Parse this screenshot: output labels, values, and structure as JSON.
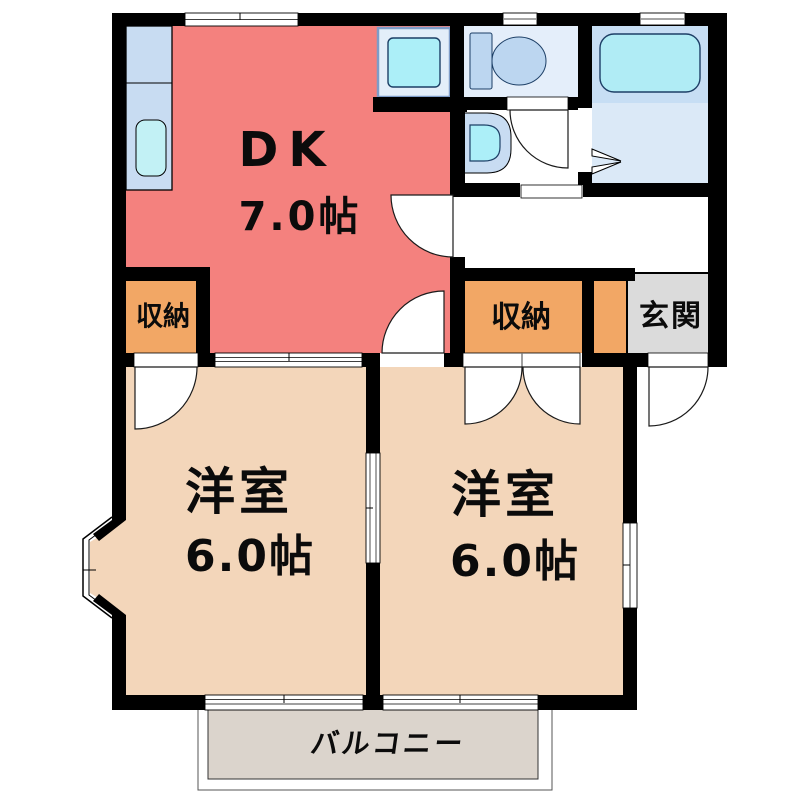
{
  "plan_title": "1DK apartment floor plan",
  "rooms": {
    "dk": {
      "label": "DK",
      "size": "7.0帖"
    },
    "western_room_left": {
      "label": "洋室",
      "size": "6.0帖"
    },
    "western_room_right": {
      "label": "洋室",
      "size": "6.0帖"
    },
    "storage_left": {
      "label": "収納"
    },
    "storage_right": {
      "label": "収納"
    },
    "entrance": {
      "label": "玄関"
    },
    "balcony": {
      "label": "バルコニー"
    }
  },
  "fixtures": [
    "kitchen-counter",
    "kitchen-sink",
    "washing-machine-pan",
    "toilet",
    "wash-basin",
    "bathtub",
    "bay-window"
  ],
  "colors": {
    "wall": "#000000",
    "dk_floor": "#F4817E",
    "western_room_floor": "#F3D6BA",
    "storage_floor": "#F2A765",
    "entrance_floor": "#DBDBDB",
    "balcony_floor": "#DBD4CC",
    "kitchen_counter": "#C8DCF2",
    "sink_cyan": "#ACEFF8",
    "bath_upper_floor": "#C7DEF4",
    "bath_lower_floor": "#DBE9F7",
    "toilet_floor": "#E4EEFA",
    "fixture_outline": "#1d3f66"
  }
}
